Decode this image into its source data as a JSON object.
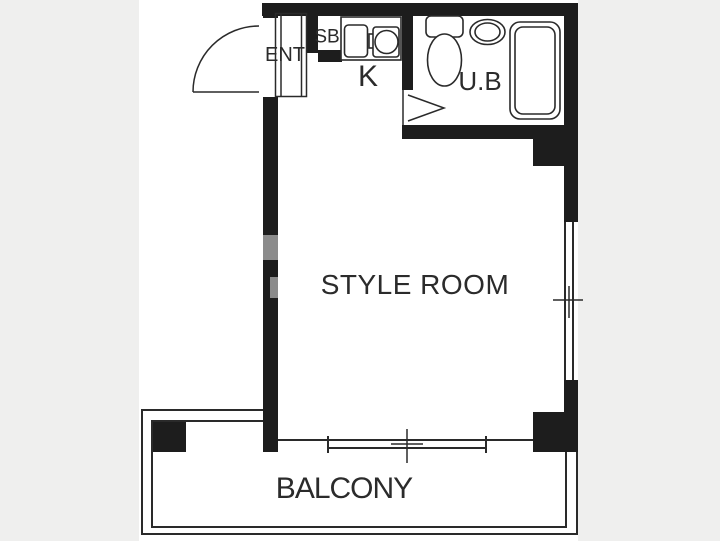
{
  "floor_plan": {
    "type": "apartment-floor-plan",
    "rooms": [
      {
        "id": "entrance",
        "label": "ENT"
      },
      {
        "id": "shoe-box",
        "label": "SB"
      },
      {
        "id": "kitchen",
        "label": "K"
      },
      {
        "id": "unit-bath",
        "label": "U.B"
      },
      {
        "id": "main-room",
        "label": "STYLE ROOM"
      },
      {
        "id": "balcony",
        "label": "BALCONY"
      }
    ],
    "fixtures": [
      "entry-door-swing-arc",
      "kitchen-sink",
      "kitchen-faucet",
      "kitchen-burner",
      "toilet",
      "wash-basin",
      "bathtub",
      "bath-door-chevron",
      "sliding-window-right",
      "sliding-window-bottom"
    ],
    "colors": {
      "background": "#efefee",
      "plan": "#ffffff",
      "wall": "#1d1d1d",
      "line": "#2a2a2a",
      "text": "#2b2b2b",
      "patch": "#8b8b8b"
    }
  }
}
